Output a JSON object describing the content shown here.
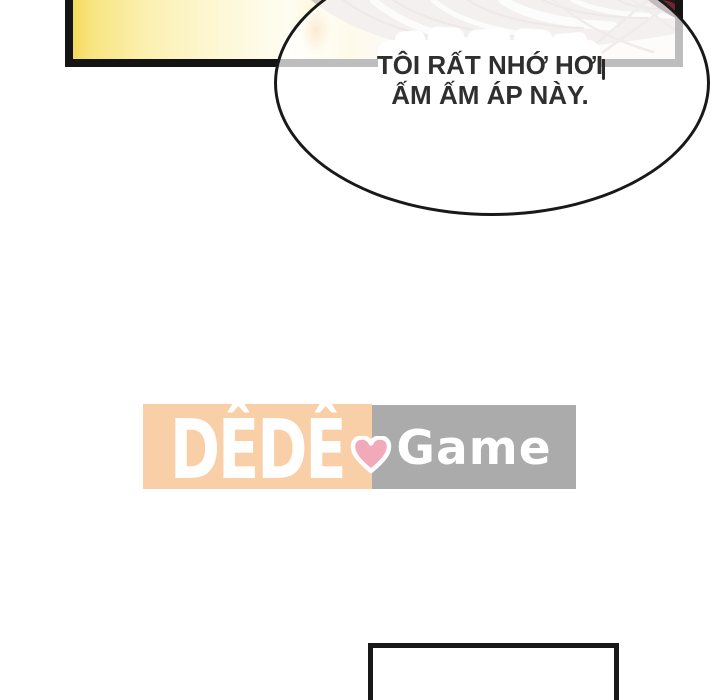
{
  "comic": {
    "speech_bubble": {
      "line1": "TÔI RẤT NHỚ HƠI",
      "line2": "ẤM ẤM ÁP NÀY.",
      "text_color": "#2f2f2f",
      "bubble_fill": "#ffffff",
      "bubble_border": "#191919"
    },
    "watermark": {
      "brand_left": "DÊDÊ",
      "brand_right": "Game",
      "heart_icon": "heart",
      "left_bg": "#f8cfa7",
      "right_bg": "#ababab",
      "heart_color": "#f2a9ba",
      "text_color": "#ffffff"
    },
    "artwork_colors": {
      "panel_border": "#141414",
      "glow_yellow": "#f6dd60",
      "glow_orange": "#f0a44e",
      "hair_base": "#d2c8c7",
      "hair_line": "#beb1b1",
      "corner_maroon": "#2e1119",
      "corner_red": "#6d2532"
    }
  }
}
